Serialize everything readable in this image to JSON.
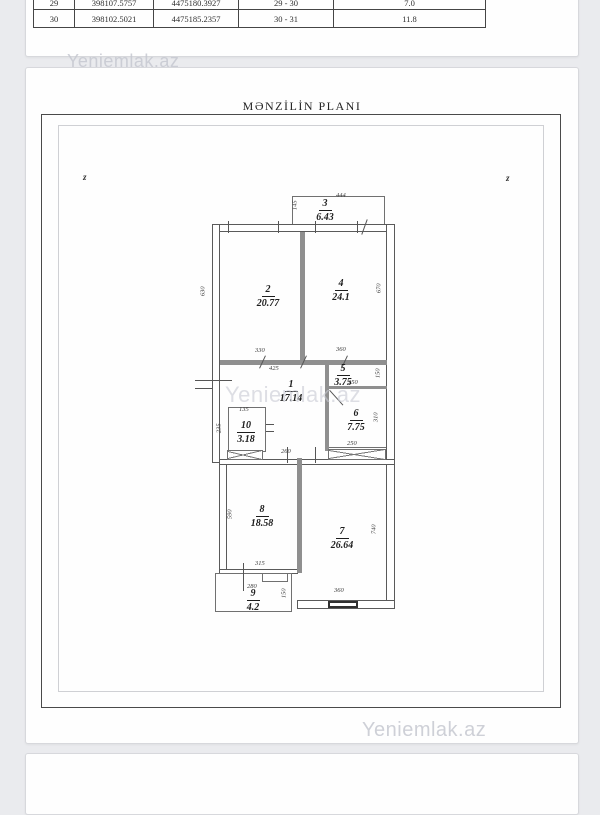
{
  "watermark": "Yeniemlak.az",
  "colors": {
    "wall_interior": "#8f8f8f",
    "wall_outline": "#5a5a5a",
    "watermark": "#d2d3d8",
    "page_bg": "#eaebee"
  },
  "survey_table": {
    "rows": [
      [
        "29",
        "398107.5757",
        "4475180.3927",
        "29 - 30",
        "7.0"
      ],
      [
        "30",
        "398102.5021",
        "4475185.2357",
        "30 - 31",
        "11.8"
      ]
    ]
  },
  "floor_plan": {
    "title": "MƏNZİLİN PLANI",
    "orientation_left": "z",
    "orientation_right": "z",
    "rooms": [
      {
        "num": "3",
        "area": "6.43"
      },
      {
        "num": "2",
        "area": "20.77"
      },
      {
        "num": "4",
        "area": "24.1"
      },
      {
        "num": "5",
        "area": "3.75"
      },
      {
        "num": "1",
        "area": "17.14"
      },
      {
        "num": "6",
        "area": "7.75"
      },
      {
        "num": "10",
        "area": "3.18"
      },
      {
        "num": "8",
        "area": "18.58"
      },
      {
        "num": "7",
        "area": "26.64"
      },
      {
        "num": "9",
        "area": "4.2"
      }
    ],
    "dims": [
      "444",
      "145",
      "630",
      "670",
      "330",
      "360",
      "425",
      "250",
      "150",
      "310",
      "250",
      "135",
      "235",
      "260",
      "590",
      "315",
      "740",
      "360",
      "280",
      "150"
    ]
  }
}
